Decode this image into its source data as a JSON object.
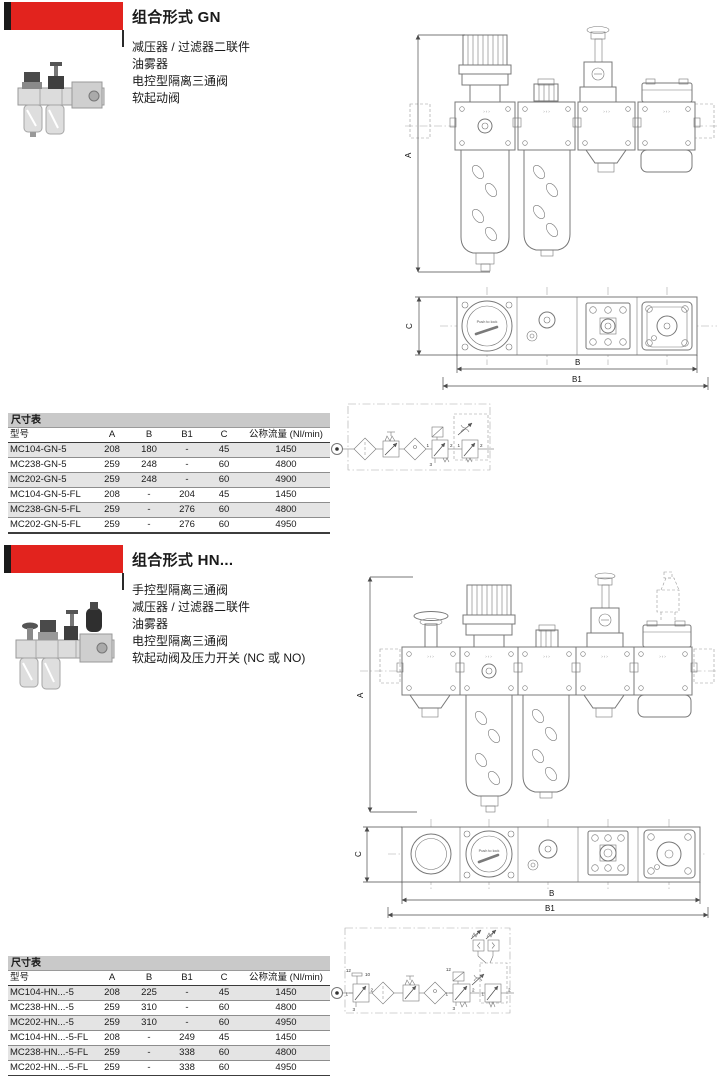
{
  "colors": {
    "accent_red": "#e2231e",
    "banner_black": "#1a1a1a",
    "table_caption_bg": "#c9c9c9",
    "row_stripe_bg": "#e4e4e4"
  },
  "sections": [
    {
      "title": "组合形式 GN",
      "description_lines": [
        "减压器 / 过滤器二联件",
        "油雾器",
        "电控型隔离三通阀",
        "软起动阀"
      ],
      "drawing": {
        "dims": {
          "a": "A",
          "b": "B",
          "b1": "B1",
          "c": "C"
        },
        "gauge_text": "Push to lock",
        "flow_mark": "›››"
      },
      "circuit": {
        "labels": [
          "1",
          "2",
          "3",
          "1",
          "2"
        ]
      },
      "table": {
        "caption": "尺寸表",
        "headers": [
          "型号",
          "A",
          "B",
          "B1",
          "C",
          "公称流量 (Nl/min)"
        ],
        "rows": [
          [
            "MC104-GN-5",
            "208",
            "180",
            "-",
            "45",
            "1450"
          ],
          [
            "MC238-GN-5",
            "259",
            "248",
            "-",
            "60",
            "4800"
          ],
          [
            "MC202-GN-5",
            "259",
            "248",
            "-",
            "60",
            "4900"
          ],
          [
            "MC104-GN-5-FL",
            "208",
            "-",
            "204",
            "45",
            "1450"
          ],
          [
            "MC238-GN-5-FL",
            "259",
            "-",
            "276",
            "60",
            "4800"
          ],
          [
            "MC202-GN-5-FL",
            "259",
            "-",
            "276",
            "60",
            "4950"
          ]
        ]
      }
    },
    {
      "title": "组合形式 HN...",
      "description_lines": [
        "手控型隔离三通阀",
        "减压器 / 过滤器二联件",
        "油雾器",
        "电控型隔离三通阀",
        "软起动阀及压力开关 (NC 或 NO)"
      ],
      "drawing": {
        "dims": {
          "a": "A",
          "b": "B",
          "b1": "B1",
          "c": "C"
        },
        "gauge_text": "Push to lock",
        "flow_mark": "›››"
      },
      "circuit": {
        "labels": [
          "12",
          "10",
          "1",
          "2",
          "3",
          "12",
          "1",
          "2",
          "3",
          "1",
          "2"
        ]
      },
      "table": {
        "caption": "尺寸表",
        "headers": [
          "型号",
          "A",
          "B",
          "B1",
          "C",
          "公称流量 (Nl/min)"
        ],
        "rows": [
          [
            "MC104-HN...-5",
            "208",
            "225",
            "-",
            "45",
            "1450"
          ],
          [
            "MC238-HN...-5",
            "259",
            "310",
            "-",
            "60",
            "4800"
          ],
          [
            "MC202-HN...-5",
            "259",
            "310",
            "-",
            "60",
            "4950"
          ],
          [
            "MC104-HN...-5-FL",
            "208",
            "-",
            "249",
            "45",
            "1450"
          ],
          [
            "MC238-HN...-5-FL",
            "259",
            "-",
            "338",
            "60",
            "4800"
          ],
          [
            "MC202-HN...-5-FL",
            "259",
            "-",
            "338",
            "60",
            "4950"
          ]
        ]
      }
    }
  ]
}
